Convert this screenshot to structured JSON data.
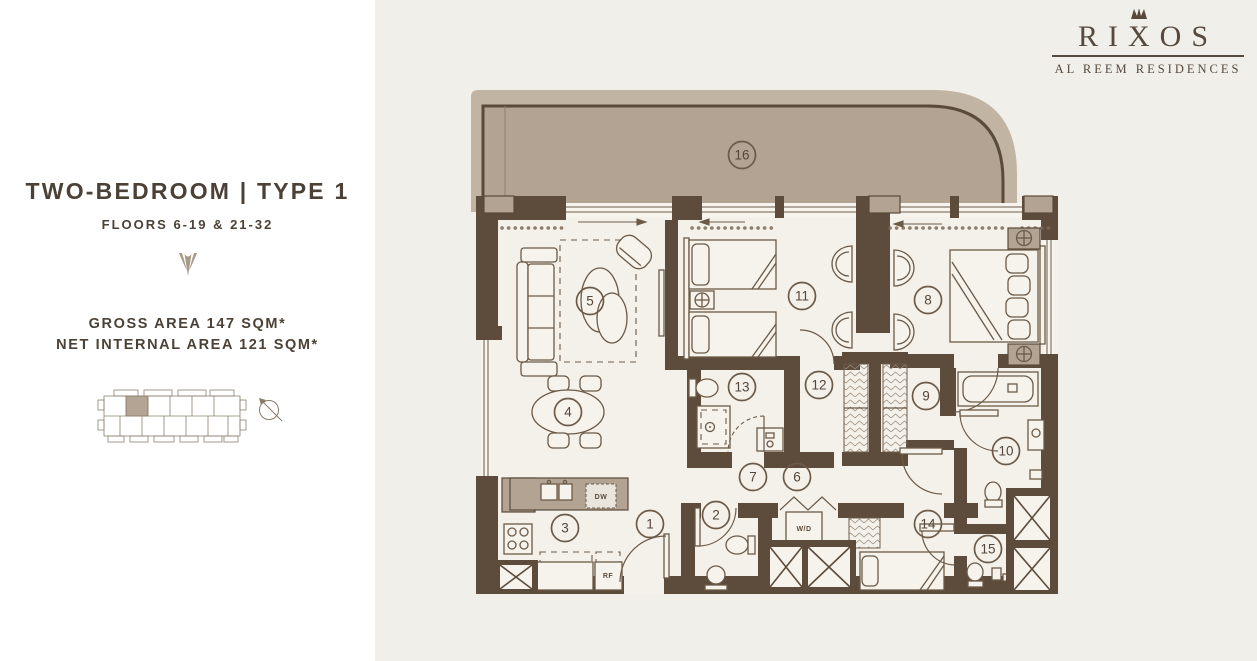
{
  "brand": {
    "wordmark_left": "RI",
    "wordmark_x": "X",
    "wordmark_right": "OS",
    "subtitle": "AL REEM RESIDENCES"
  },
  "unit": {
    "title": "TWO-BEDROOM | TYPE 1",
    "floors": "FLOORS 6-19 & 21-32",
    "gross_area": "GROSS AREA 147 SQM*",
    "net_area": "NET INTERNAL AREA 121 SQM*"
  },
  "plan": {
    "markers": [
      {
        "n": "1",
        "x": 650,
        "y": 524
      },
      {
        "n": "2",
        "x": 716,
        "y": 515
      },
      {
        "n": "3",
        "x": 565,
        "y": 528
      },
      {
        "n": "4",
        "x": 568,
        "y": 412
      },
      {
        "n": "5",
        "x": 590,
        "y": 301
      },
      {
        "n": "6",
        "x": 797,
        "y": 477
      },
      {
        "n": "7",
        "x": 753,
        "y": 477
      },
      {
        "n": "8",
        "x": 928,
        "y": 300
      },
      {
        "n": "9",
        "x": 926,
        "y": 396
      },
      {
        "n": "10",
        "x": 1006,
        "y": 451
      },
      {
        "n": "11",
        "x": 802,
        "y": 296
      },
      {
        "n": "12",
        "x": 819,
        "y": 385
      },
      {
        "n": "13",
        "x": 742,
        "y": 387
      },
      {
        "n": "14",
        "x": 928,
        "y": 524
      },
      {
        "n": "15",
        "x": 988,
        "y": 549
      },
      {
        "n": "16",
        "x": 742,
        "y": 155
      }
    ],
    "appliances": {
      "dishwasher": "DW",
      "refrigerator": "RF",
      "washer_dryer": "W/D"
    }
  },
  "colors": {
    "wall": "#5d4b3b",
    "balcony_fill": "#b2a392",
    "balcony_band": "#c2b4a3",
    "background_right": "#f0efe9",
    "background_left": "#ffffff",
    "text": "#4b4136",
    "brand_text": "#57493c",
    "accent_tan": "#a89a87"
  }
}
